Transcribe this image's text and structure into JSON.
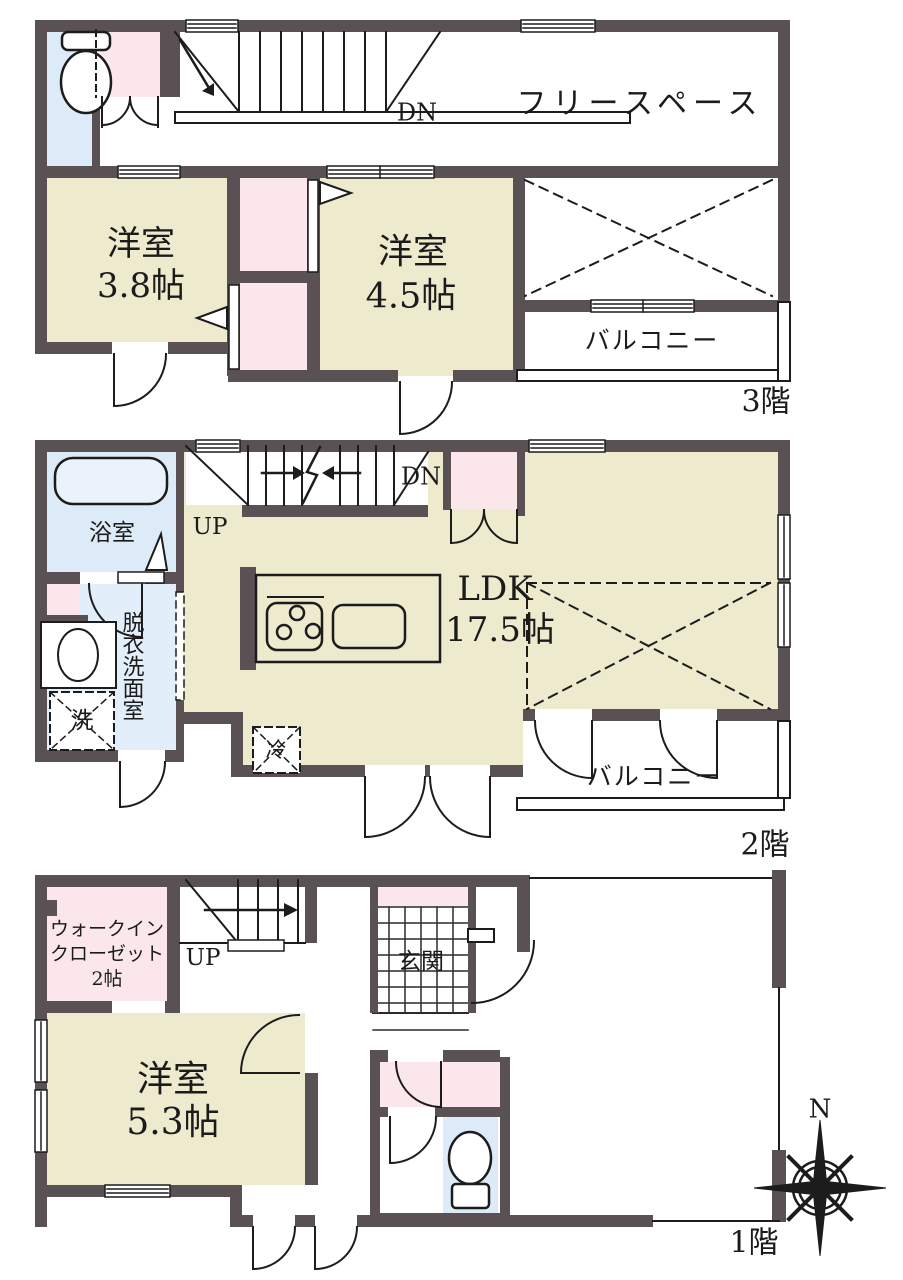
{
  "document": {
    "type": "floor-plan",
    "orientation_mark": "N"
  },
  "colors": {
    "wall": "#595153",
    "room_tan": "#edeacd",
    "closet_pink": "#fbe7eb",
    "water_blue": "#dcebf7",
    "washroom_blue": "#e2eefa",
    "line": "#1c1c1c"
  },
  "floors": {
    "third": {
      "label": "3階",
      "rooms": {
        "free_space": "フリースペース",
        "youshitsu38": {
          "name": "洋室",
          "size": "3.8帖"
        },
        "youshitsu45": {
          "name": "洋室",
          "size": "4.5帖"
        },
        "balcony": "バルコニー",
        "stair_down": "DN"
      }
    },
    "second": {
      "label": "2階",
      "rooms": {
        "bath": "浴室",
        "washroom": "脱衣洗面室",
        "ldk_name": "LDK",
        "ldk_size": "17.5帖",
        "balcony": "バルコニー",
        "washer": "洗",
        "fridge": "冷",
        "stair_up": "UP",
        "stair_down": "DN"
      }
    },
    "first": {
      "label": "1階",
      "rooms": {
        "wic_line1": "ウォークイン",
        "wic_line2": "クローゼット",
        "wic_line3": "2帖",
        "entrance": "玄関",
        "youshitsu53_name": "洋室",
        "youshitsu53_size": "5.3帖",
        "stair_up": "UP",
        "compass_north": "N"
      }
    }
  }
}
